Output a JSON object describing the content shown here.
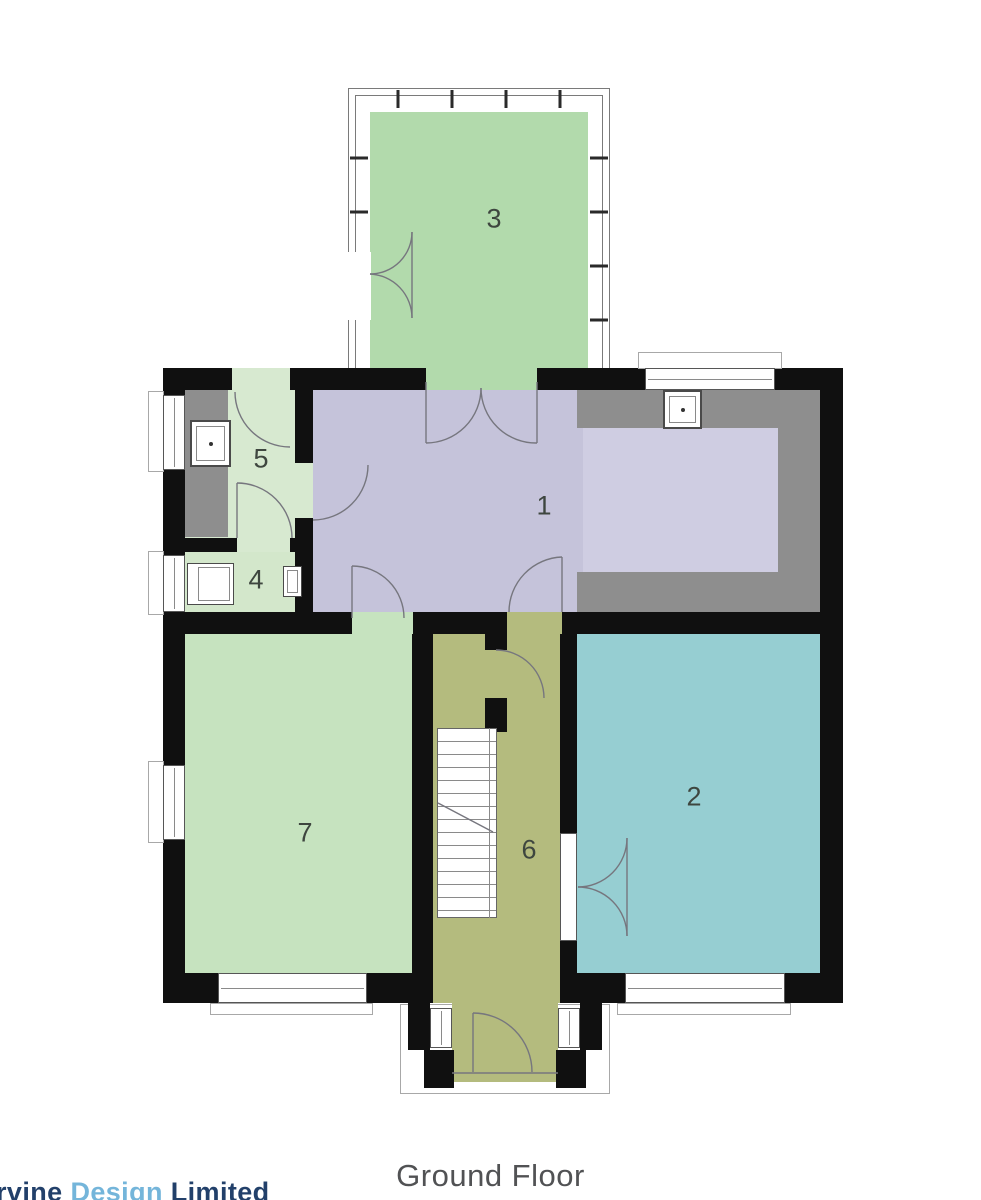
{
  "title": "Ground Floor",
  "logo": {
    "part1": "rvine ",
    "part2": "Design",
    "part3": " Limited"
  },
  "rooms": {
    "r1": {
      "label": "1",
      "color": "#c5c3da"
    },
    "r2": {
      "label": "2",
      "color": "#96ced2"
    },
    "r3": {
      "label": "3",
      "color": "#b2daac"
    },
    "r4": {
      "label": "4",
      "color": "#d3e7cb"
    },
    "r5": {
      "label": "5",
      "color": "#d7e9d0"
    },
    "r6": {
      "label": "6",
      "color": "#b4bb7e"
    },
    "r7": {
      "label": "7",
      "color": "#c6e3bf"
    }
  },
  "palette": {
    "wall": "#101010",
    "counter": "#8e8e8e",
    "kitchen_floor": "#cfcde2",
    "door_line": "#76767e",
    "title_color": "#515254",
    "logo_navy": "#22406a",
    "logo_blue": "#74b5da"
  }
}
